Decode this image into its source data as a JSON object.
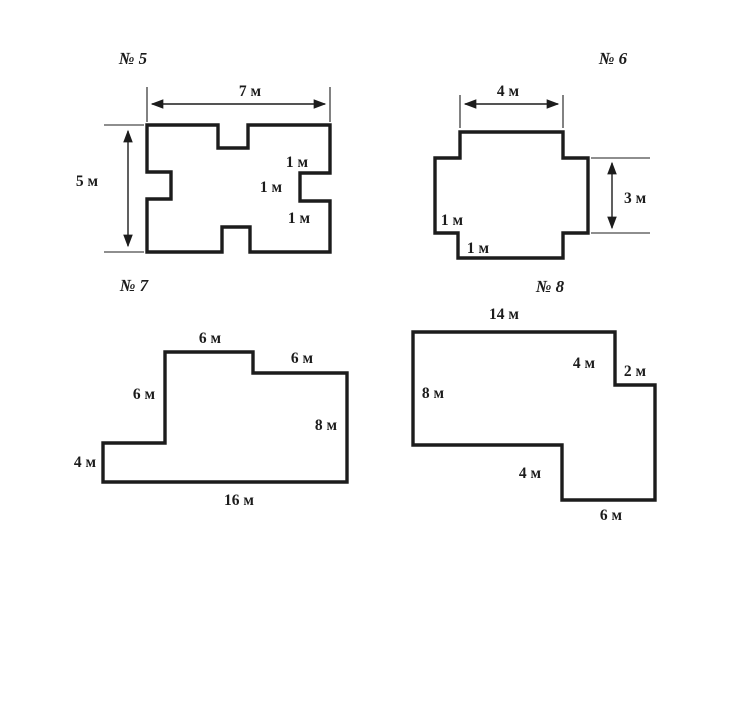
{
  "colors": {
    "ink": "#1c1c1c",
    "background": "#ffffff"
  },
  "figures": {
    "f5": {
      "title": "№ 5",
      "dims": {
        "width": "7 м",
        "height": "5 м",
        "notch_top": "1 м",
        "notch_mid": "1 м",
        "notch_bottom": "1 м"
      }
    },
    "f6": {
      "title": "№ 6",
      "dims": {
        "top": "4 м",
        "right": "3 м",
        "left_step": "1 м",
        "bottom_step": "1 м"
      }
    },
    "f7": {
      "title": "№ 7",
      "dims": {
        "top": "6 м",
        "top_right": "6 м",
        "left_upper": "6 м",
        "right": "8 м",
        "left_lower": "4 м",
        "bottom": "16 м"
      }
    },
    "f8": {
      "title": "№ 8",
      "dims": {
        "top": "14 м",
        "right_upper": "4 м",
        "step": "2 м",
        "left": "8 м",
        "inner_vertical": "4 м",
        "bottom": "6 м"
      }
    }
  }
}
